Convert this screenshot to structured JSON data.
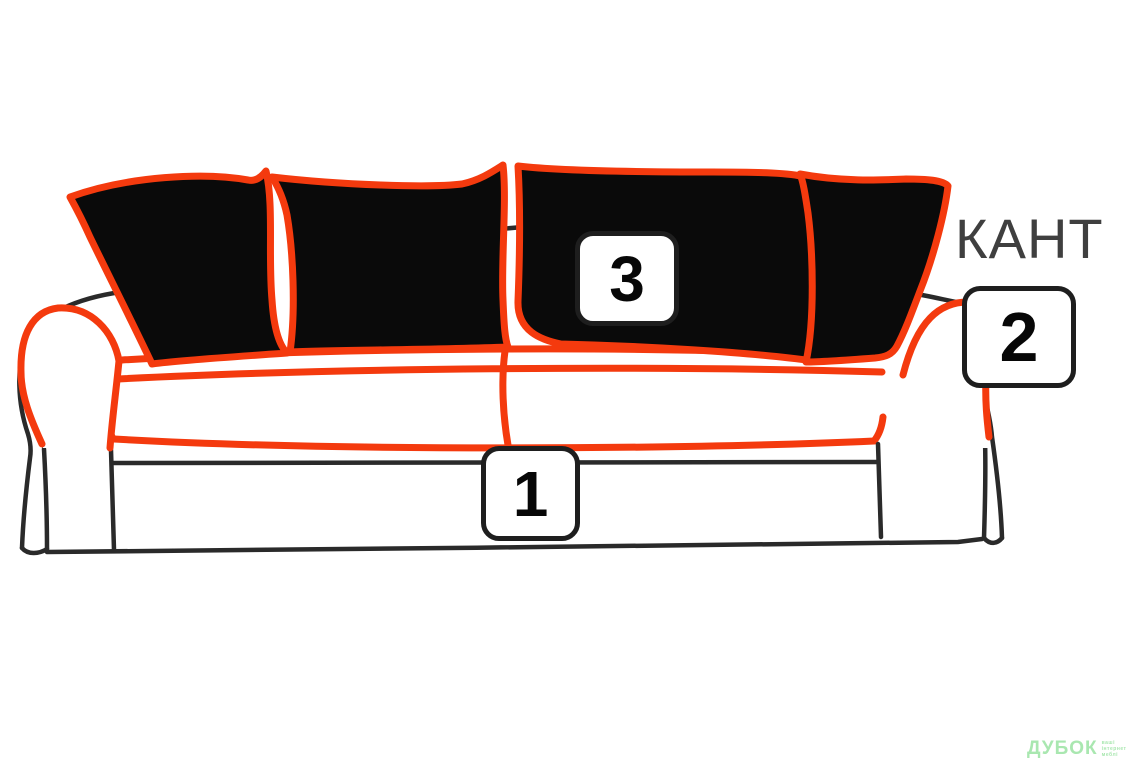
{
  "figure": {
    "kant_label": "КАНТ",
    "badges": [
      {
        "number": "1"
      },
      {
        "number": "2"
      },
      {
        "number": "3"
      }
    ]
  },
  "watermark": {
    "brand": "ДУБОК",
    "tagline_lines": [
      "ваші",
      "інтернет",
      "меблі"
    ]
  },
  "colors": {
    "background": "#ffffff",
    "piping-red": "#f43a0e",
    "pillow-black": "#0a0a0a",
    "outline-black": "#2a2a2a",
    "label-gray": "#3f3f3f",
    "badge-bg": "#ffffff",
    "badge-border": "#1e1e1e",
    "badge-text": "#070707",
    "watermark-green": "#a9e7b0"
  }
}
